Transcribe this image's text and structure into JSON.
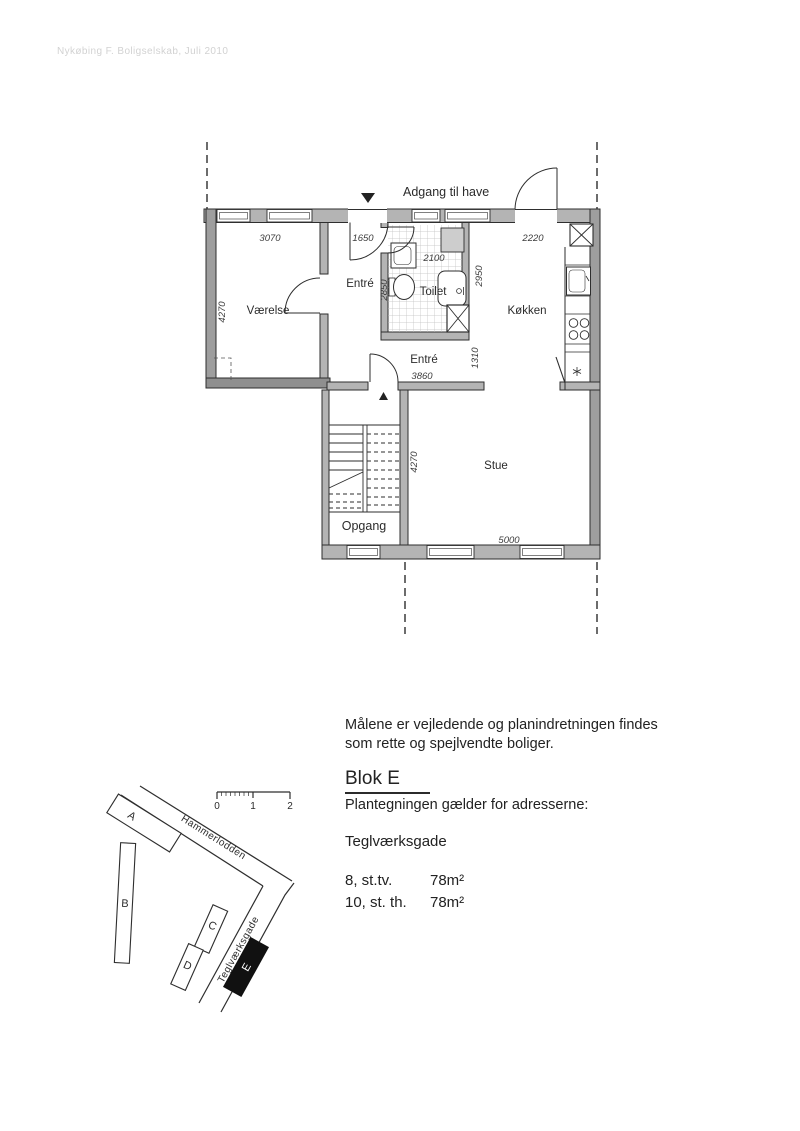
{
  "watermark": "Nykøbing F. Boligselskab, Juli 2010",
  "floor_plan": {
    "garden_access_label": "Adgang til have",
    "rooms": {
      "vaerelse": "Værelse",
      "entre_upper": "Entré",
      "toilet": "Toilet",
      "koekken": "Køkken",
      "entre_lower": "Entré",
      "stue": "Stue",
      "opgang": "Opgang"
    },
    "dimensions": {
      "vaerelse_width": "3070",
      "vaerelse_depth": "4270",
      "entre_width": "1650",
      "toilet_width": "2100",
      "toilet_depth": "2850",
      "koekken_width": "2220",
      "koekken_depth": "2950",
      "hall_length": "3860",
      "hall_width": "1310",
      "stue_depth": "4270",
      "stue_width": "5000"
    }
  },
  "site_map": {
    "scale_ticks": [
      "0",
      "1",
      "2"
    ],
    "streets": {
      "hammerlodden": "Hammerlodden",
      "teglvaerksgade": "Teglværksgade"
    },
    "buildings": [
      {
        "label": "A"
      },
      {
        "label": "B"
      },
      {
        "label": "C"
      },
      {
        "label": "D"
      },
      {
        "label": "E"
      }
    ],
    "highlight_color": "#111111"
  },
  "info": {
    "note_line1": "Målene er vejledende og planindretningen findes",
    "note_line2": "som rette og spejlvendte boliger.",
    "block_title": "Blok E",
    "subtitle": "Plantegningen gælder for adresserne:",
    "street_name": "Teglværksgade",
    "units": [
      {
        "address": "8, st.tv.",
        "area": "78m²"
      },
      {
        "address": "10, st. th.",
        "area": "78m²"
      }
    ]
  }
}
